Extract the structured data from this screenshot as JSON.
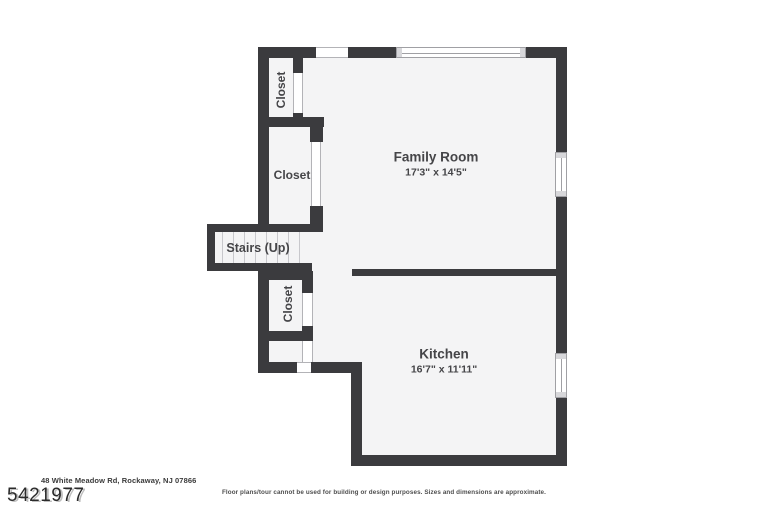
{
  "floorplan": {
    "rooms": [
      {
        "name": "Family Room",
        "dimensions": "17'3\" x 14'5\""
      },
      {
        "name": "Kitchen",
        "dimensions": "16'7\" x 11'11\""
      }
    ],
    "closets": [
      "Closet",
      "Closet",
      "Closet"
    ],
    "stairs_label": "Stairs (Up)"
  },
  "footer": {
    "address": "48 White Meadow Rd, Rockaway, NJ 07866",
    "listing_number": "5421977",
    "disclaimer": "Floor plans/tour cannot be used for building or design purposes. Sizes and dimensions are approximate."
  },
  "colors": {
    "wall": "#3b3b3e",
    "room_fill": "#f4f4f5",
    "label_text": "#454548",
    "opening_line": "#b3b3b7",
    "window_line": "#a0a0a4",
    "background": "#ffffff"
  }
}
